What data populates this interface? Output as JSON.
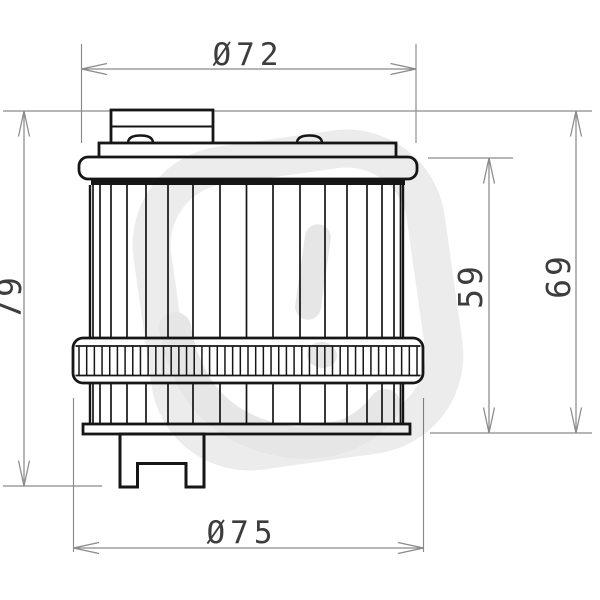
{
  "page": {
    "background": "#ffffff"
  },
  "drawing": {
    "title": "oil-filter-side-view-technical-drawing",
    "colors": {
      "outline": "#161616",
      "dimension_line": "#8a8a8a",
      "dimension_text": "#3d3d3d",
      "watermark": "#ececec",
      "watermark_inner": "#e6e6e6"
    },
    "dimensions": {
      "top_diameter": "Ø72",
      "bottom_diameter": "Ø75",
      "overall_height": "79",
      "body_height": "59",
      "height_to_base": "69"
    }
  }
}
